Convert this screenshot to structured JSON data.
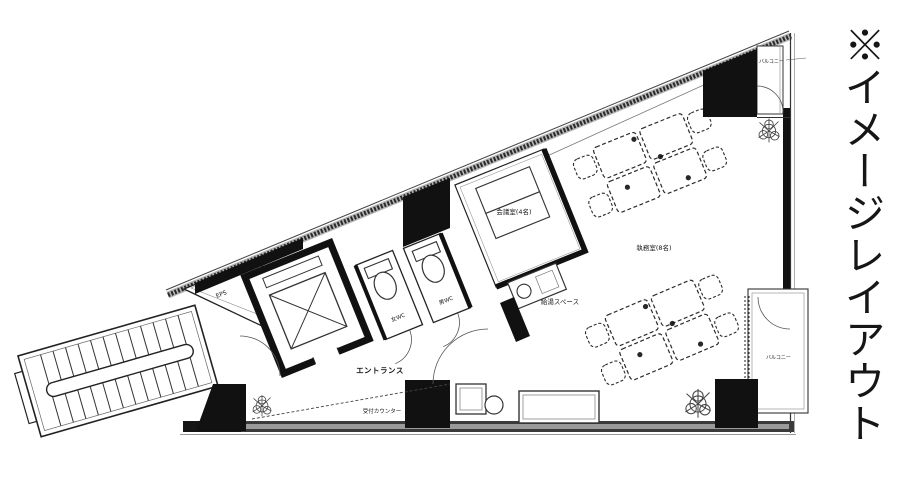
{
  "labels": {
    "annotation": "※イメージレイアウト",
    "balcony_top": "バルコニー",
    "balcony_right": "バルコニー",
    "eps": "EPS",
    "wc_left": "女WC",
    "wc_right": "男WC",
    "meeting_room": "会議室(4名)",
    "office_room": "執務室(8名)",
    "kitchenette": "給湯スペース",
    "entrance": "エントランス",
    "reception_counter": "受付カウンター"
  },
  "colors": {
    "ink": "#161616",
    "wall_fill": "#111111",
    "band_gray": "#9a9a9a"
  }
}
